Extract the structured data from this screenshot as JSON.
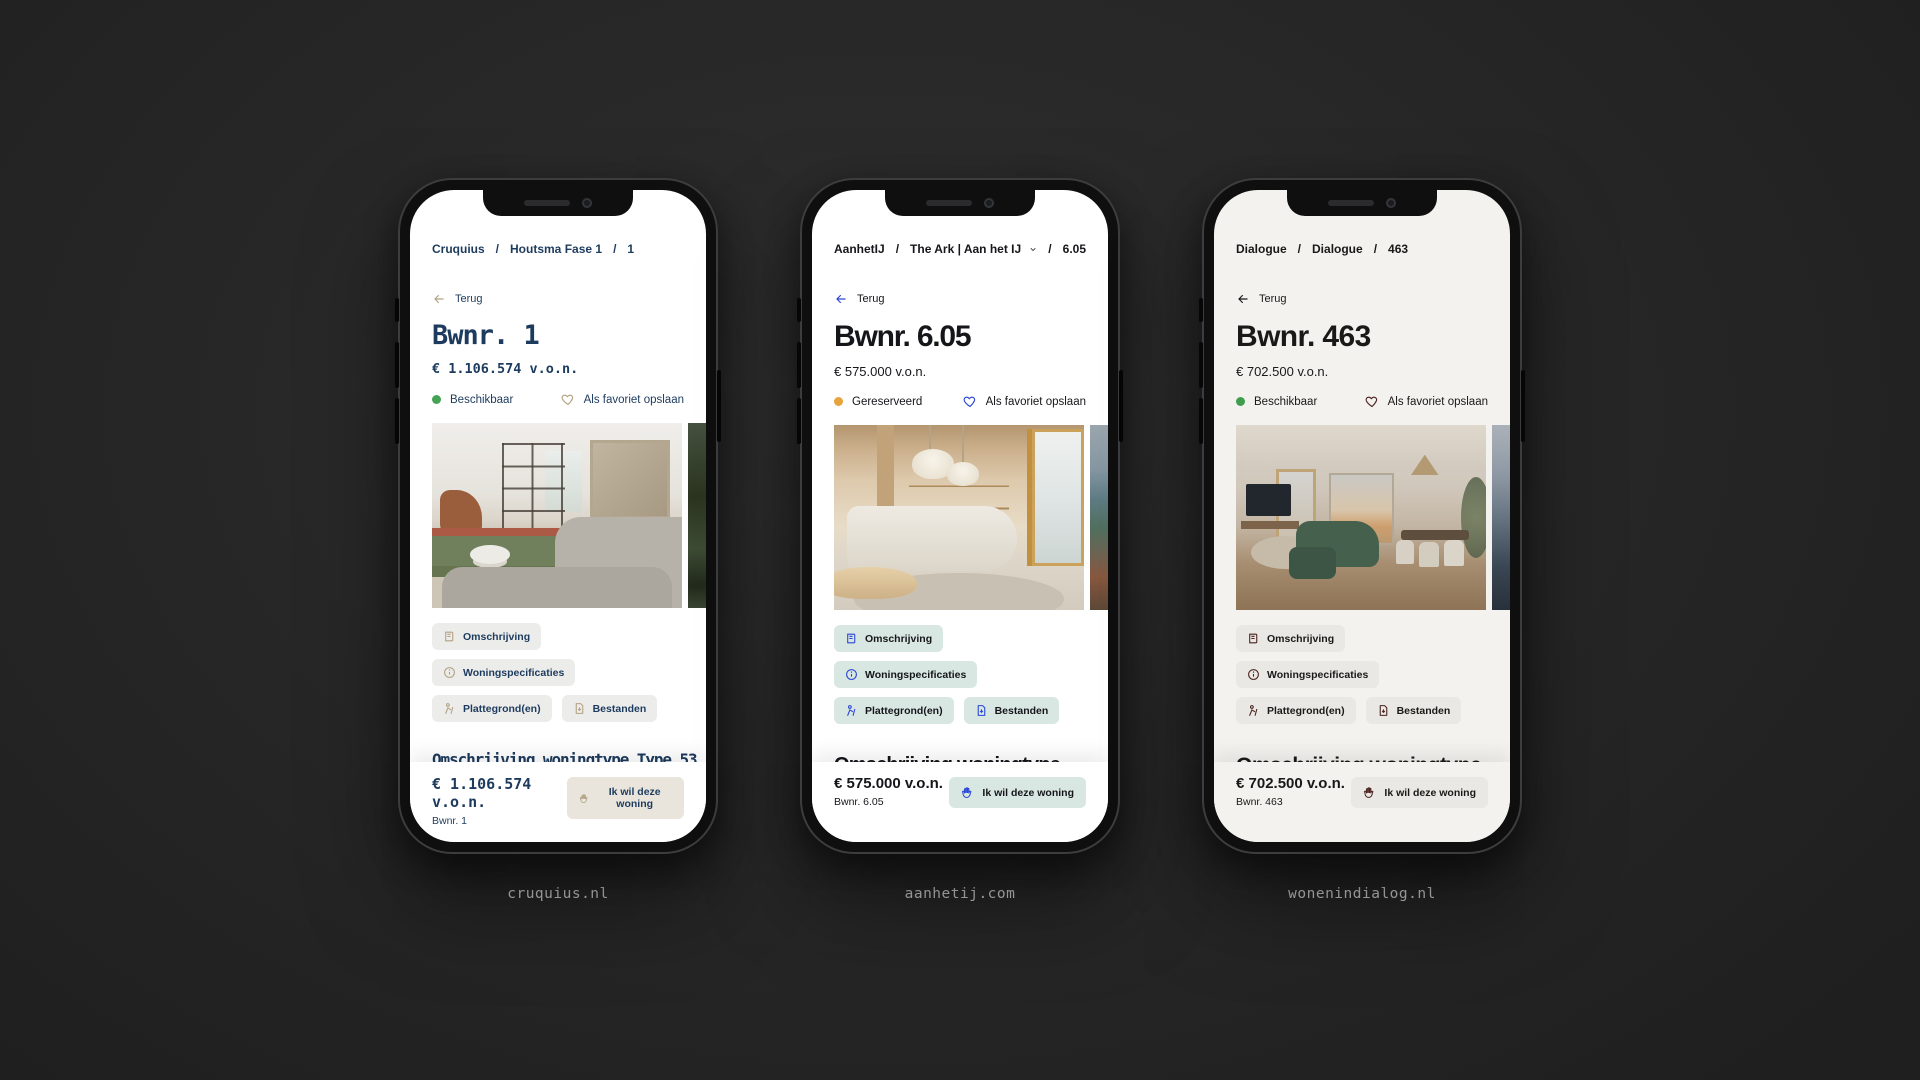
{
  "ui": {
    "separator": "/"
  },
  "phones": [
    {
      "site": "cruquius.nl",
      "theme": {
        "text": "#1d3b5e",
        "accent": "#b3a282",
        "arrow": "#b3a282",
        "tabbg": "#ececea",
        "btnbg": "#e9e5dc",
        "screen": "#ffffff"
      },
      "breadcrumb": [
        "Cruquius",
        "Houtsma Fase 1",
        "1"
      ],
      "back_label": "Terug",
      "title": "Bwnr. 1",
      "price": "€ 1.106.574 v.o.n.",
      "status": {
        "label": "Beschikbaar",
        "color": "#45a355"
      },
      "favorite_label": "Als favoriet opslaan",
      "tabs": [
        "Omschrijving",
        "Woningspecificaties",
        "Plattegrond(en)",
        "Bestanden"
      ],
      "heading": "Omschrijving woningtype Type 53",
      "body": "Deze stadswoning met een woonoppervlakte van maar liefst 158 m2, ligt op de hoek van Houtsma Zuid. De woning heeft een eigen entree aan de Cruquiusweg en biedt bijzonder veel",
      "bottom": {
        "price": "€ 1.106.574 v.o.n.",
        "unit": "Bwnr. 1",
        "cta": "Ik wil deze woning"
      }
    },
    {
      "site": "aanhetij.com",
      "theme": {
        "text": "#15161a",
        "accent": "#2a46d4",
        "arrow": "#2a46d4",
        "tabbg": "#d9e7e2",
        "btnbg": "#d9e7e2",
        "screen": "#ffffff"
      },
      "breadcrumb": [
        "AanhetIJ",
        "The Ark | Aan het IJ",
        "6.05"
      ],
      "back_label": "Terug",
      "title": "Bwnr. 6.05",
      "price": "€ 575.000 v.o.n.",
      "status": {
        "label": "Gereserveerd",
        "color": "#e8a33c"
      },
      "favorite_label": "Als favoriet opslaan",
      "tabs": [
        "Omschrijving",
        "Woningspecificaties",
        "Plattegrond(en)",
        "Bestanden"
      ],
      "heading": "Omschrijving woningtype 22s",
      "body": "Dit 2-kamerappartement ligt op de 6e en 7e verdieping en",
      "bottom": {
        "price": "€ 575.000 v.o.n.",
        "unit": "Bwnr. 6.05",
        "cta": "Ik wil deze woning"
      }
    },
    {
      "site": "wonenindialog.nl",
      "theme": {
        "text": "#1b1917",
        "accent": "#4b2420",
        "arrow": "#1b1917",
        "tabbg": "#eae8e4",
        "btnbg": "#eae8e4",
        "screen": "#f4f2ef"
      },
      "breadcrumb": [
        "Dialogue",
        "Dialogue",
        "463"
      ],
      "back_label": "Terug",
      "title": "Bwnr. 463",
      "price": "€ 702.500 v.o.n.",
      "status": {
        "label": "Beschikbaar",
        "color": "#3f9e4d"
      },
      "favorite_label": "Als favoriet opslaan",
      "tabs": [
        "Omschrijving",
        "Woningspecificaties",
        "Plattegrond(en)",
        "Bestanden"
      ],
      "heading": "Omschrijving woningtype KD01 Skyline residence (Amstel view)",
      "body": "",
      "bottom": {
        "price": "€ 702.500 v.o.n.",
        "unit": "Bwnr. 463",
        "cta": "Ik wil deze woning"
      }
    }
  ]
}
